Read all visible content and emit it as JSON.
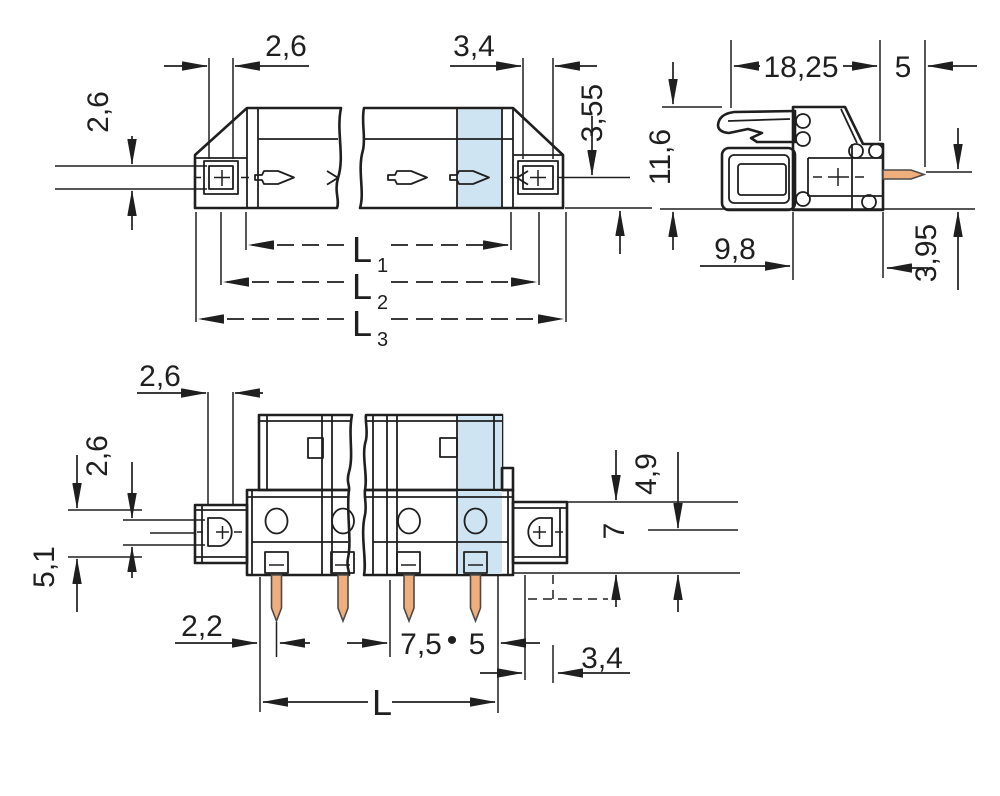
{
  "drawing": {
    "type": "technical-dimension-drawing",
    "subject": "pcb-terminal-connector",
    "colors": {
      "body_gray": "#b5b7b9",
      "highlight_blue": "#cfe4f2",
      "pin_orange": "#f1ae7d",
      "line": "#1f1f1f",
      "background": "#ffffff"
    },
    "labels": {
      "side": {
        "flange_contact_width": "2,6",
        "flange_contact_width_right": "3,4",
        "contact_height": "2,6",
        "pin_axis_to_bottom": "3,55",
        "l1": "L",
        "l1_sub": "1",
        "l2": "L",
        "l2_sub": "2",
        "l3": "L",
        "l3_sub": "3"
      },
      "profile": {
        "housing_depth": "18,25",
        "pin_length": "5",
        "housing_height": "11,6",
        "lower_depth": "9,8",
        "pin_axis_to_bottom": "3,95"
      },
      "front": {
        "flange_hole_width": "2,6",
        "flange_hole_height": "2,6",
        "flange_zone_height": "5,1",
        "edge_offset": "2,2",
        "pitch_a": "7,5",
        "pitch_dot": "•",
        "pitch_b": "5",
        "side_gap": "3,4",
        "flange_height": "7",
        "pin_axis_to_bottom": "4,9",
        "overall_length": "L"
      }
    }
  }
}
